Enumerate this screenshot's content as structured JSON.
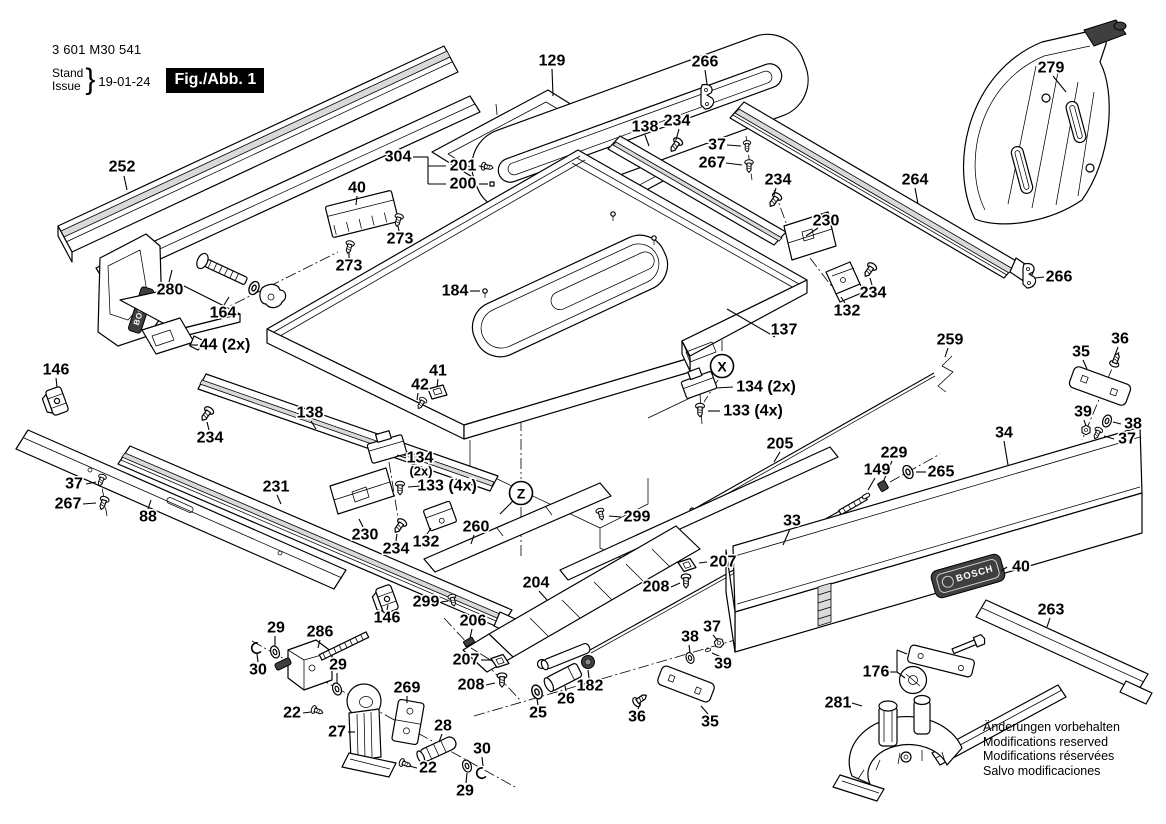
{
  "header": {
    "type_number": "3 601 M30 541",
    "stand_label": "Stand",
    "issue_label": "Issue",
    "date": "19-01-24",
    "figure_label": "Fig./Abb. 1"
  },
  "brand": {
    "name": "BOSCH"
  },
  "footer_notes": [
    "Änderungen vorbehalten",
    "Modifications reserved",
    "Modifications réservées",
    "Salvo modificaciones"
  ],
  "view_markers": [
    {
      "letter": "X",
      "x": 722,
      "y": 366
    },
    {
      "letter": "Z",
      "x": 521,
      "y": 493,
      "lead": [
        [
          513,
          501,
          500,
          514
        ]
      ]
    }
  ],
  "part_labels": [
    {
      "t": "252",
      "x": 122,
      "y": 167,
      "lead": [
        [
          124,
          176,
          127,
          190
        ]
      ]
    },
    {
      "t": "304",
      "x": 398,
      "y": 157,
      "lead": [
        [
          413,
          157,
          428,
          157
        ],
        [
          428,
          157,
          428,
          184
        ],
        [
          428,
          166,
          446,
          166
        ],
        [
          428,
          184,
          446,
          184
        ]
      ]
    },
    {
      "t": "201",
      "x": 463,
      "y": 166,
      "lead": [
        [
          479,
          166,
          484,
          167
        ]
      ]
    },
    {
      "t": "200",
      "x": 463,
      "y": 184,
      "lead": [
        [
          479,
          184,
          488,
          184
        ]
      ]
    },
    {
      "t": "129",
      "x": 552,
      "y": 61,
      "lead": [
        [
          552,
          69,
          553,
          96
        ]
      ]
    },
    {
      "t": "266",
      "x": 705,
      "y": 62,
      "lead": [
        [
          705,
          70,
          707,
          84
        ]
      ]
    },
    {
      "t": "279",
      "x": 1051,
      "y": 68,
      "lead": [
        [
          1053,
          76,
          1066,
          92
        ]
      ]
    },
    {
      "t": "138",
      "x": 645,
      "y": 127,
      "lead": [
        [
          645,
          135,
          649,
          146
        ]
      ]
    },
    {
      "t": "234",
      "x": 677,
      "y": 121,
      "lead": [
        [
          679,
          129,
          676,
          140
        ]
      ]
    },
    {
      "t": "37",
      "x": 717,
      "y": 145,
      "lead": [
        [
          727,
          145,
          741,
          146
        ]
      ]
    },
    {
      "t": "267",
      "x": 712,
      "y": 163,
      "lead": [
        [
          726,
          163,
          742,
          165
        ]
      ]
    },
    {
      "t": "234",
      "x": 778,
      "y": 180,
      "lead": [
        [
          776,
          188,
          774,
          195
        ]
      ]
    },
    {
      "t": "264",
      "x": 915,
      "y": 180,
      "lead": [
        [
          915,
          188,
          918,
          204
        ]
      ]
    },
    {
      "t": "230",
      "x": 826,
      "y": 221,
      "lead": [
        [
          818,
          228,
          806,
          236
        ]
      ]
    },
    {
      "t": "266",
      "x": 1059,
      "y": 277,
      "lead": [
        [
          1044,
          277,
          1035,
          278
        ]
      ]
    },
    {
      "t": "234",
      "x": 873,
      "y": 293,
      "lead": [
        [
          872,
          285,
          870,
          278
        ]
      ]
    },
    {
      "t": "132",
      "x": 847,
      "y": 311,
      "lead": [
        [
          845,
          303,
          841,
          297
        ]
      ]
    },
    {
      "t": "137",
      "x": 784,
      "y": 330,
      "lead": [
        [
          775,
          337,
          727,
          309
        ]
      ]
    },
    {
      "t": "184",
      "x": 455,
      "y": 291,
      "lead": [
        [
          470,
          291,
          480,
          291
        ]
      ]
    },
    {
      "t": "134 (2x)",
      "x": 766,
      "y": 387,
      "lead": [
        [
          733,
          387,
          716,
          388
        ]
      ]
    },
    {
      "t": "133 (4x)",
      "x": 753,
      "y": 411,
      "lead": [
        [
          720,
          411,
          708,
          411
        ]
      ]
    },
    {
      "t": "259",
      "x": 950,
      "y": 340,
      "lead": [
        [
          948,
          348,
          945,
          357
        ]
      ]
    },
    {
      "t": "36",
      "x": 1120,
      "y": 339,
      "lead": [
        [
          1118,
          347,
          1115,
          355
        ]
      ]
    },
    {
      "t": "35",
      "x": 1081,
      "y": 352,
      "lead": [
        [
          1083,
          360,
          1087,
          369
        ]
      ]
    },
    {
      "t": "39",
      "x": 1083,
      "y": 412,
      "lead": [
        [
          1084,
          420,
          1086,
          426
        ]
      ]
    },
    {
      "t": "38",
      "x": 1133,
      "y": 424,
      "lead": [
        [
          1121,
          424,
          1113,
          422
        ]
      ]
    },
    {
      "t": "37",
      "x": 1127,
      "y": 439,
      "lead": [
        [
          1114,
          439,
          1104,
          436
        ]
      ]
    },
    {
      "t": "34",
      "x": 1004,
      "y": 433,
      "lead": [
        [
          1004,
          441,
          1008,
          465
        ]
      ]
    },
    {
      "t": "205",
      "x": 780,
      "y": 444,
      "lead": [
        [
          780,
          452,
          774,
          462
        ]
      ]
    },
    {
      "t": "229",
      "x": 894,
      "y": 453,
      "lead": [
        [
          892,
          461,
          884,
          480
        ]
      ]
    },
    {
      "t": "149",
      "x": 877,
      "y": 470,
      "lead": [
        [
          875,
          478,
          868,
          490
        ]
      ]
    },
    {
      "t": "265",
      "x": 941,
      "y": 472,
      "lead": [
        [
          926,
          472,
          916,
          472
        ]
      ]
    },
    {
      "t": "33",
      "x": 792,
      "y": 521,
      "lead": [
        [
          790,
          529,
          783,
          545
        ]
      ]
    },
    {
      "t": "41",
      "x": 438,
      "y": 371,
      "lead": [
        [
          438,
          379,
          437,
          387
        ]
      ]
    },
    {
      "t": "42",
      "x": 420,
      "y": 385,
      "lead": [
        [
          418,
          393,
          417,
          400
        ]
      ]
    },
    {
      "t": "138",
      "x": 310,
      "y": 413,
      "lead": [
        [
          311,
          421,
          316,
          429
        ]
      ]
    },
    {
      "t": "234",
      "x": 210,
      "y": 438,
      "lead": [
        [
          209,
          430,
          207,
          422
        ]
      ]
    },
    {
      "t": "231",
      "x": 276,
      "y": 487,
      "lead": [
        [
          277,
          495,
          281,
          504
        ]
      ]
    },
    {
      "t": "37",
      "x": 74,
      "y": 484,
      "lead": [
        [
          86,
          484,
          96,
          482
        ]
      ]
    },
    {
      "t": "267",
      "x": 68,
      "y": 504,
      "lead": [
        [
          83,
          504,
          96,
          503
        ]
      ]
    },
    {
      "t": "88",
      "x": 148,
      "y": 517,
      "lead": [
        [
          148,
          509,
          151,
          500
        ]
      ]
    },
    {
      "t": "134",
      "x": 420,
      "y": 458,
      "lead": [
        [
          406,
          458,
          397,
          455
        ]
      ]
    },
    {
      "t": "(2x)",
      "x": 421,
      "y": 471,
      "s": true
    },
    {
      "t": "133 (4x)",
      "x": 447,
      "y": 486,
      "lead": [
        [
          421,
          486,
          408,
          487
        ]
      ]
    },
    {
      "t": "230",
      "x": 365,
      "y": 535,
      "lead": [
        [
          363,
          527,
          359,
          519
        ]
      ]
    },
    {
      "t": "234",
      "x": 396,
      "y": 549,
      "lead": [
        [
          396,
          541,
          397,
          534
        ]
      ]
    },
    {
      "t": "132",
      "x": 426,
      "y": 542,
      "lead": [
        [
          427,
          534,
          431,
          528
        ]
      ]
    },
    {
      "t": "260",
      "x": 476,
      "y": 527,
      "lead": [
        [
          474,
          535,
          471,
          544
        ]
      ]
    },
    {
      "t": "299",
      "x": 637,
      "y": 517,
      "lead": [
        [
          621,
          517,
          609,
          516
        ]
      ]
    },
    {
      "t": "204",
      "x": 536,
      "y": 583,
      "lead": [
        [
          539,
          591,
          547,
          600
        ]
      ]
    },
    {
      "t": "207",
      "x": 723,
      "y": 562,
      "lead": [
        [
          707,
          562,
          699,
          563
        ]
      ]
    },
    {
      "t": "208",
      "x": 656,
      "y": 587,
      "lead": [
        [
          671,
          587,
          680,
          583
        ]
      ]
    },
    {
      "t": "299",
      "x": 426,
      "y": 602,
      "lead": [
        [
          441,
          602,
          448,
          601
        ]
      ]
    },
    {
      "t": "146",
      "x": 387,
      "y": 618,
      "lead": [
        [
          387,
          610,
          388,
          605
        ]
      ]
    },
    {
      "t": "206",
      "x": 473,
      "y": 621,
      "lead": [
        [
          472,
          629,
          470,
          638
        ]
      ]
    },
    {
      "t": "207",
      "x": 466,
      "y": 660,
      "lead": [
        [
          481,
          660,
          491,
          660
        ]
      ]
    },
    {
      "t": "208",
      "x": 471,
      "y": 685,
      "lead": [
        [
          486,
          685,
          495,
          683
        ]
      ]
    },
    {
      "t": "29",
      "x": 276,
      "y": 628,
      "lead": [
        [
          275,
          636,
          275,
          646
        ]
      ]
    },
    {
      "t": "286",
      "x": 320,
      "y": 632,
      "lead": [
        [
          320,
          640,
          318,
          648
        ]
      ]
    },
    {
      "t": "30",
      "x": 258,
      "y": 670,
      "lead": [
        [
          258,
          662,
          257,
          654
        ]
      ]
    },
    {
      "t": "29",
      "x": 338,
      "y": 665,
      "lead": [
        [
          337,
          673,
          337,
          683
        ]
      ]
    },
    {
      "t": "22",
      "x": 292,
      "y": 713,
      "lead": [
        [
          303,
          713,
          311,
          712
        ]
      ]
    },
    {
      "t": "27",
      "x": 337,
      "y": 732,
      "lead": [
        [
          348,
          732,
          355,
          732
        ]
      ]
    },
    {
      "t": "269",
      "x": 407,
      "y": 688,
      "lead": [
        [
          407,
          696,
          407,
          703
        ]
      ]
    },
    {
      "t": "28",
      "x": 443,
      "y": 726,
      "lead": [
        [
          442,
          734,
          439,
          742
        ]
      ]
    },
    {
      "t": "22",
      "x": 428,
      "y": 768,
      "lead": [
        [
          417,
          768,
          409,
          766
        ]
      ]
    },
    {
      "t": "30",
      "x": 482,
      "y": 749,
      "lead": [
        [
          482,
          757,
          483,
          766
        ]
      ]
    },
    {
      "t": "29",
      "x": 465,
      "y": 791,
      "lead": [
        [
          466,
          783,
          467,
          773
        ]
      ]
    },
    {
      "t": "25",
      "x": 538,
      "y": 713,
      "lead": [
        [
          538,
          705,
          537,
          699
        ]
      ]
    },
    {
      "t": "26",
      "x": 566,
      "y": 699,
      "lead": [
        [
          566,
          691,
          565,
          686
        ]
      ]
    },
    {
      "t": "182",
      "x": 590,
      "y": 686,
      "lead": [
        [
          589,
          678,
          588,
          670
        ]
      ]
    },
    {
      "t": "36",
      "x": 637,
      "y": 717,
      "lead": [
        [
          638,
          709,
          640,
          704
        ]
      ]
    },
    {
      "t": "35",
      "x": 710,
      "y": 722,
      "lead": [
        [
          708,
          714,
          701,
          706
        ]
      ]
    },
    {
      "t": "38",
      "x": 690,
      "y": 637,
      "lead": [
        [
          689,
          645,
          690,
          653
        ]
      ]
    },
    {
      "t": "37",
      "x": 712,
      "y": 627,
      "lead": [
        [
          713,
          635,
          718,
          641
        ]
      ]
    },
    {
      "t": "39",
      "x": 723,
      "y": 664,
      "lead": [
        [
          721,
          657,
          712,
          653
        ]
      ]
    },
    {
      "t": "40",
      "x": 1021,
      "y": 567,
      "lead": [
        [
          1007,
          567,
          1001,
          571
        ]
      ]
    },
    {
      "t": "263",
      "x": 1051,
      "y": 610,
      "lead": [
        [
          1050,
          618,
          1047,
          627
        ]
      ]
    },
    {
      "t": "176",
      "x": 876,
      "y": 672,
      "lead": [
        [
          889,
          672,
          897,
          672
        ],
        [
          897,
          672,
          897,
          650
        ],
        [
          897,
          650,
          907,
          654
        ],
        [
          897,
          672,
          905,
          678
        ]
      ]
    },
    {
      "t": "281",
      "x": 838,
      "y": 703,
      "lead": [
        [
          852,
          703,
          862,
          706
        ]
      ]
    },
    {
      "t": "280",
      "x": 170,
      "y": 290,
      "lead": [
        [
          169,
          282,
          172,
          270
        ]
      ]
    },
    {
      "t": "164",
      "x": 223,
      "y": 313,
      "lead": [
        [
          224,
          305,
          229,
          297
        ]
      ]
    },
    {
      "t": "44 (2x)",
      "x": 225,
      "y": 345,
      "lead": [
        [
          198,
          345,
          189,
          345
        ]
      ]
    },
    {
      "t": "146",
      "x": 56,
      "y": 370,
      "lead": [
        [
          56,
          378,
          57,
          387
        ]
      ]
    },
    {
      "t": "40",
      "x": 357,
      "y": 188,
      "lead": [
        [
          357,
          196,
          356,
          205
        ]
      ]
    },
    {
      "t": "273",
      "x": 400,
      "y": 239,
      "lead": [
        [
          399,
          231,
          398,
          226
        ]
      ]
    },
    {
      "t": "273",
      "x": 349,
      "y": 266,
      "lead": [
        [
          349,
          258,
          349,
          252
        ]
      ]
    }
  ]
}
